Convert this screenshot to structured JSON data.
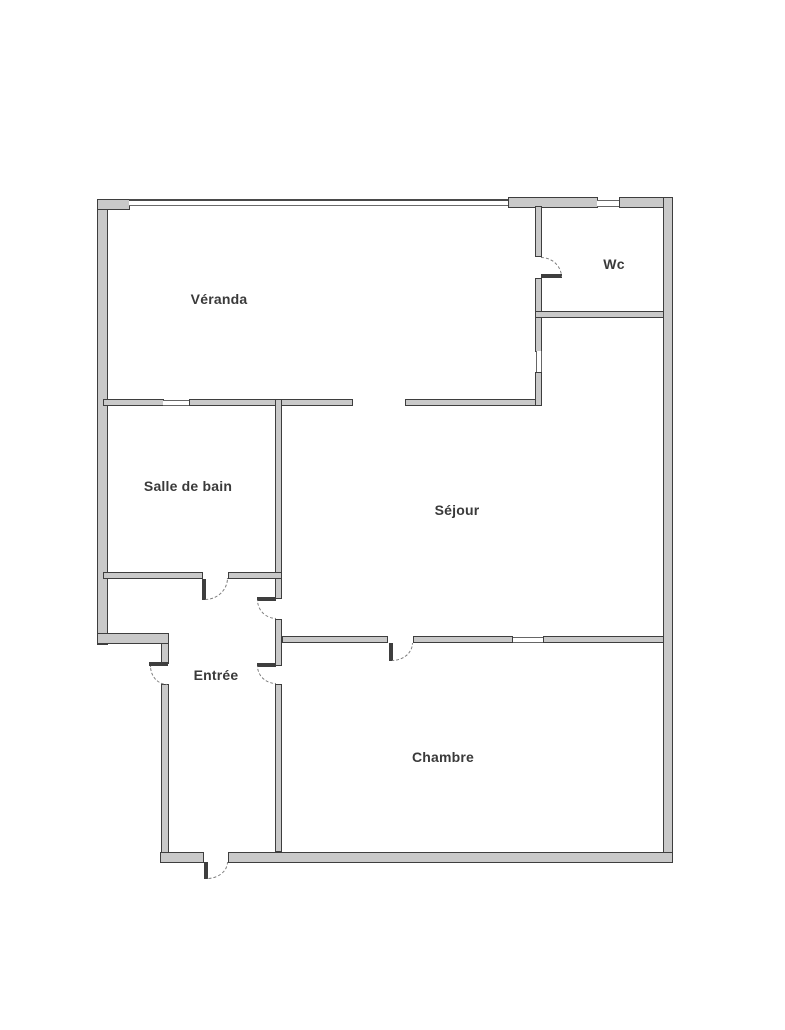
{
  "plan": {
    "title": "apartment-floor-plan",
    "rooms": [
      {
        "id": "veranda",
        "label": "Véranda"
      },
      {
        "id": "wc",
        "label": "Wc"
      },
      {
        "id": "salle-de-bain",
        "label": "Salle de bain"
      },
      {
        "id": "sejour",
        "label": "Séjour"
      },
      {
        "id": "entree",
        "label": "Entrée"
      },
      {
        "id": "chambre",
        "label": "Chambre"
      }
    ],
    "colors": {
      "background": "#ffffff",
      "wall_fill": "#c9c9c9",
      "wall_edge": "#3e3e3e",
      "label_text": "#3a3a3a",
      "door_arc": "#7a7a7a"
    }
  }
}
